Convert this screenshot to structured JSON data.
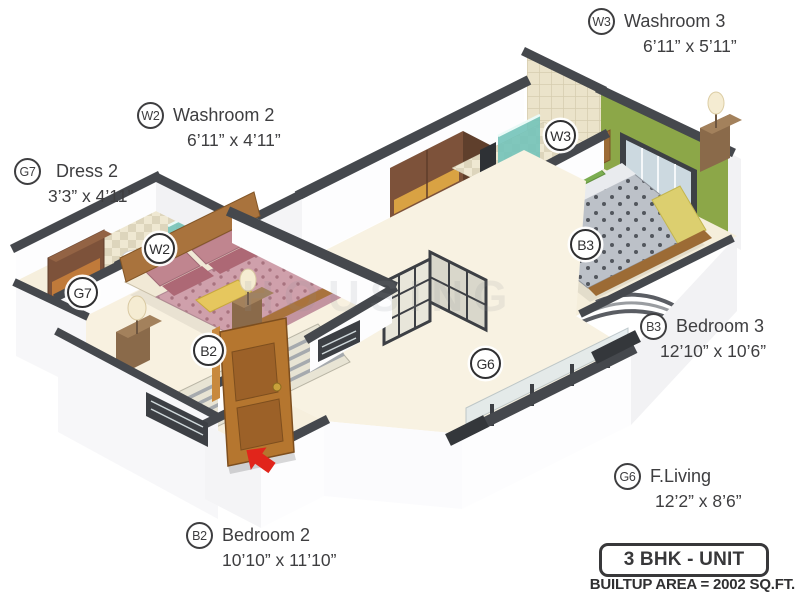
{
  "unit": {
    "type_label": "3 BHK - UNIT",
    "builtup_area_label": "BUILTUP AREA = 2002 SQ.FT."
  },
  "watermark": "HOUSING",
  "rooms": [
    {
      "code": "W3",
      "name": "Washroom 3",
      "dims": "6’11” x 5’11”"
    },
    {
      "code": "W2",
      "name": "Washroom 2",
      "dims": "6’11” x 4’11”"
    },
    {
      "code": "G7",
      "name": "Dress 2",
      "dims": "3’3” x 4’11”"
    },
    {
      "code": "B3",
      "name": "Bedroom 3",
      "dims": "12’10” x 10’6”"
    },
    {
      "code": "G6",
      "name": "F.Living",
      "dims": "12’2” x 8’6”"
    },
    {
      "code": "B2",
      "name": "Bedroom 2",
      "dims": "10’10” x 11’10”"
    }
  ],
  "colors": {
    "accent_wall": "#8ca748",
    "entry_arrow": "#e1251b",
    "wall_cap": "#45484d",
    "floor": "#f8f2e2"
  }
}
